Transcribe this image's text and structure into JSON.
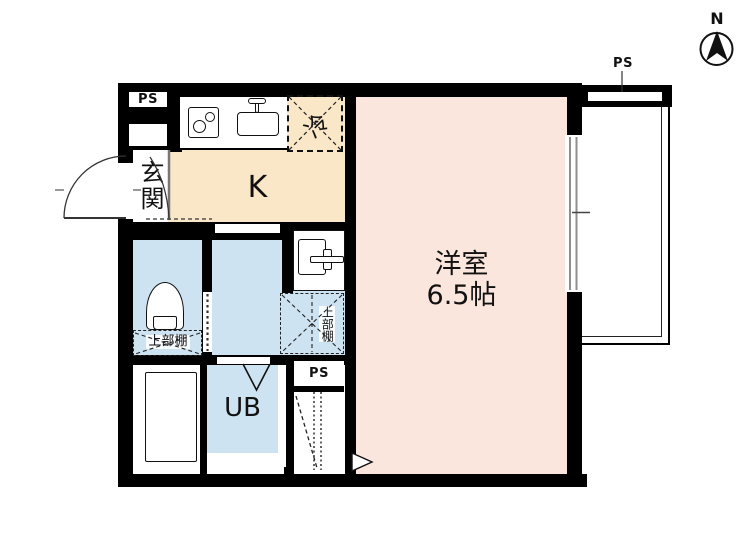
{
  "colors": {
    "wall": "#000000",
    "background": "#ffffff",
    "main_room_pink": "#fbe6de",
    "kitchen_beige": "#fae7c8",
    "wet_area_blue": "#cde3f1"
  },
  "compass": {
    "label": "N"
  },
  "labels": {
    "ps": "PS",
    "entrance": "玄関",
    "kitchen": "K",
    "fridge": "冷",
    "main_room_name": "洋室",
    "main_room_size": "6.5帖",
    "unit_bath": "UB",
    "upper_shelf": "上部棚"
  },
  "icons": {
    "compass_needle": "filled-triangle-north",
    "stove": "two-burner-cooktop",
    "sink": "kitchen-sink-with-faucet",
    "washbasin": "vanity-sink-with-faucet",
    "toilet": "toilet-bowl",
    "washing_pan": "washing-machine-pan",
    "fridge_space": "dashed-x-box",
    "upper_shelf": "dashed-x-box",
    "folding_door": "v-fold-door",
    "ladder": "dashed-ladder-lines",
    "step_arrow": "chevron-right",
    "entrance_door": "quarter-arc-door-swing"
  }
}
